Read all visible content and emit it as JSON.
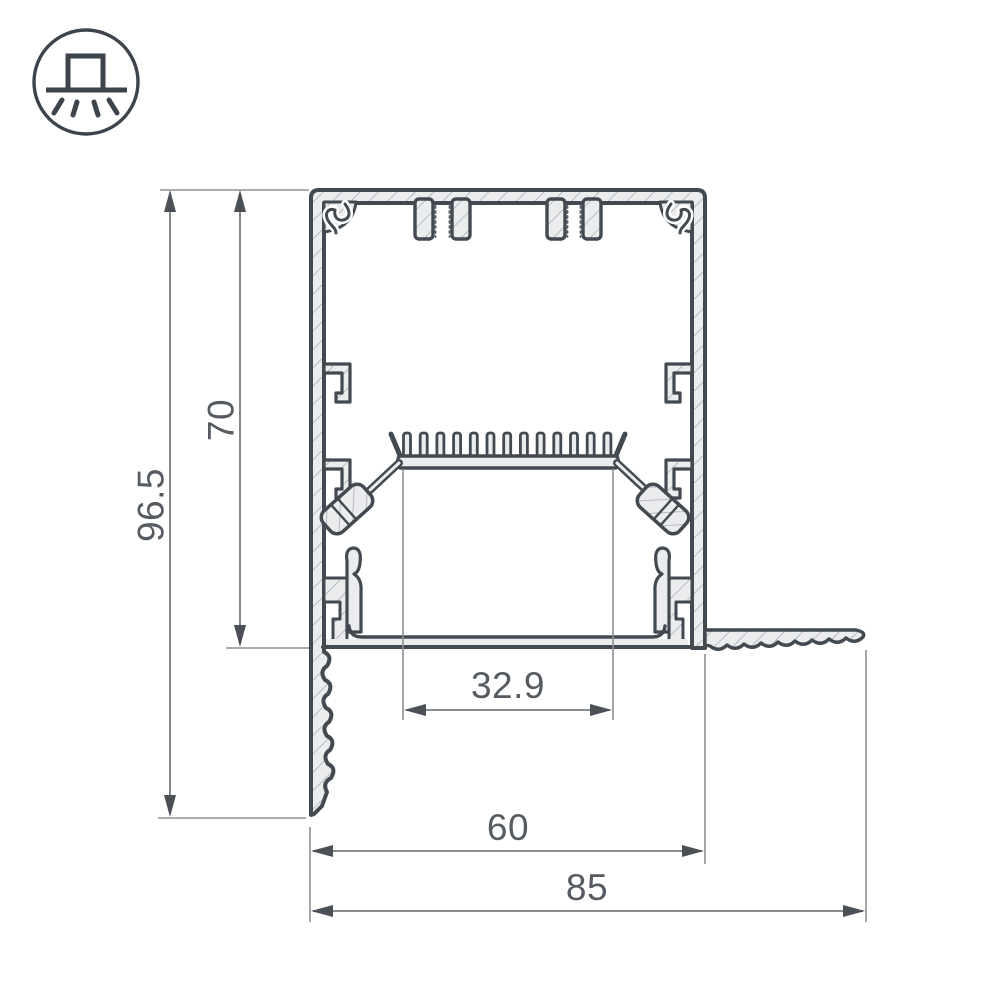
{
  "page": {
    "background": "#ffffff"
  },
  "icon": {
    "name": "surface-ceiling-light-icon",
    "description": "circled pictogram of a luminaire box on a ceiling line with light rays shining down"
  },
  "drawing": {
    "type": "technical-cross-section",
    "subject": "aluminium-led-profile-with-diffuser-and-plaster-in-flanges",
    "colors": {
      "outline": "#434950",
      "hatch_fill": "#ebecee",
      "hatch_line": "#a2a7ad",
      "dimension_line": "#767b80",
      "arrow": "#4a5056",
      "text": "#565b62"
    },
    "dimensions": [
      {
        "id": "overall-height",
        "label": "96.5",
        "orientation": "vertical"
      },
      {
        "id": "body-height",
        "label": "70",
        "orientation": "vertical"
      },
      {
        "id": "inner-width",
        "label": "32.9",
        "orientation": "horizontal"
      },
      {
        "id": "body-width",
        "label": "60",
        "orientation": "horizontal"
      },
      {
        "id": "overall-width",
        "label": "85",
        "orientation": "horizontal"
      }
    ]
  }
}
